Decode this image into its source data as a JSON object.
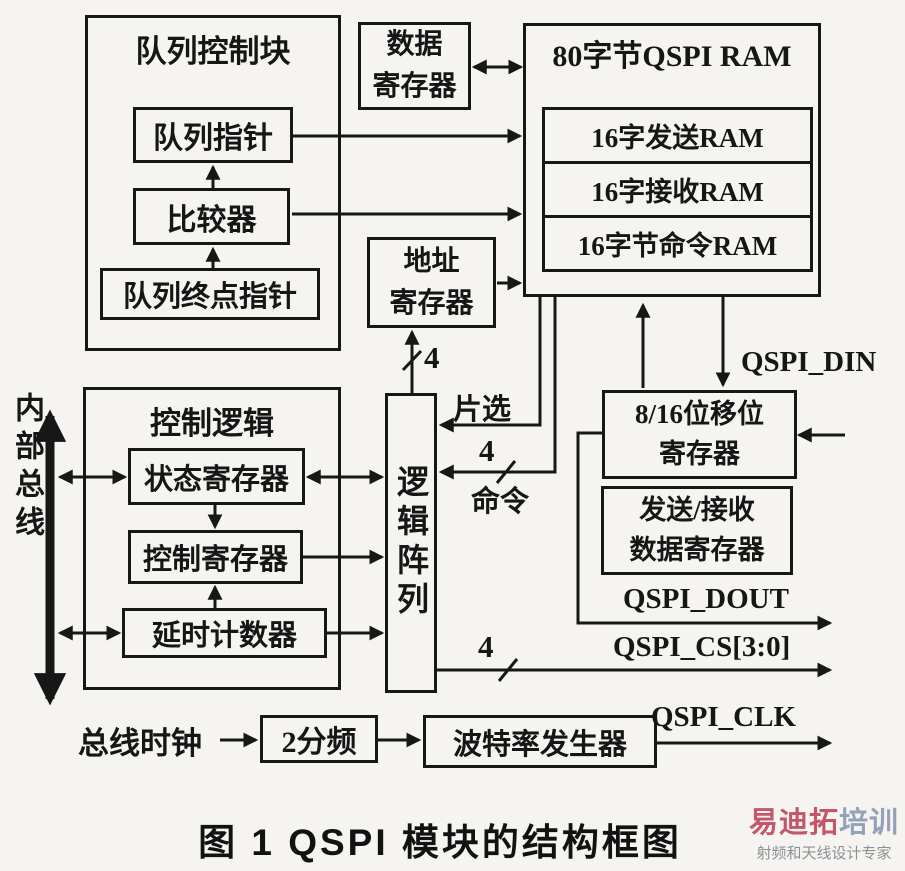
{
  "blocks": {
    "queue_control_block": "队列控制块",
    "queue_pointer": "队列指针",
    "comparator": "比较器",
    "queue_end_pointer": "队列终点指针",
    "data_register": [
      "数据",
      "寄存器"
    ],
    "qspi_ram_title": "80字节QSPI RAM",
    "ram_rows": [
      "16字发送RAM",
      "16字接收RAM",
      "16字节命令RAM"
    ],
    "address_register": [
      "地址",
      "寄存器"
    ],
    "control_logic": "控制逻辑",
    "status_register": "状态寄存器",
    "control_register": "控制寄存器",
    "delay_counter": "延时计数器",
    "logic_array": "逻辑阵列",
    "shift_register": [
      "8/16位移位",
      "寄存器"
    ],
    "txrx_data_register": [
      "发送/接收",
      "数据寄存器"
    ],
    "divide_by_2": "2分频",
    "baud_rate_generator": "波特率发生器"
  },
  "signals": {
    "qspi_din": "QSPI_DIN",
    "qspi_dout": "QSPI_DOUT",
    "qspi_cs": "QSPI_CS[3:0]",
    "qspi_clk": "QSPI_CLK"
  },
  "annotations": {
    "internal_bus": "内部总线",
    "chip_select": "片选",
    "command": "命令",
    "bus_clock": "总线时钟",
    "addr_width": "4",
    "cmd_width": "4",
    "cs_width": "4"
  },
  "caption": "图 1  QSPI 模块的结构框图",
  "watermark": {
    "brand_primary": "易迪拓",
    "brand_secondary": "培训",
    "tagline": "射频和天线设计专家",
    "colors": {
      "brand_primary": "#c4566a",
      "brand_secondary": "#93a2b8",
      "tagline": "#8d9196"
    }
  }
}
